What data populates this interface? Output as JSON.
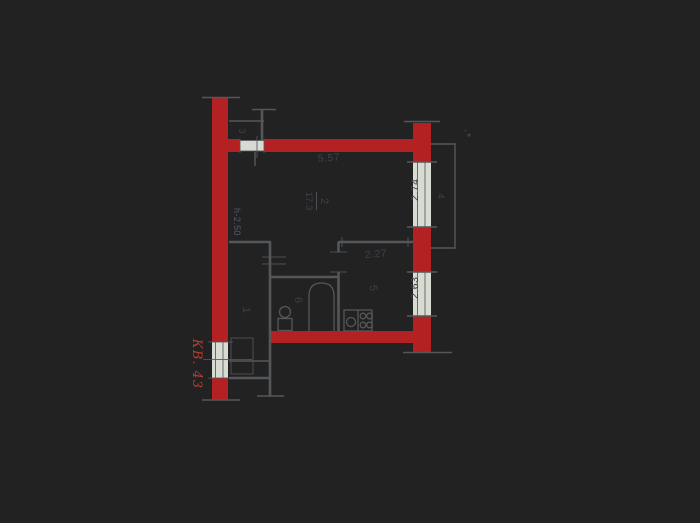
{
  "plan": {
    "apartment_label": "КВ. 43",
    "ceiling_height_label": "h-2.50",
    "rooms": {
      "hall": {
        "number": "1"
      },
      "living": {
        "number": "2",
        "area": "17.3"
      },
      "closet": {
        "number": "3"
      },
      "balcony": {
        "number": "4"
      },
      "kitchen": {
        "number": "5"
      },
      "bathroom": {
        "number": "6"
      }
    },
    "dimensions": {
      "living_width": "5.57",
      "living_window_width": "2.74",
      "kitchen_width": "2.27",
      "kitchen_window_width": "2.63"
    },
    "colors": {
      "wall_color": "#b92021",
      "line_color": "#54575a",
      "gap_color": "#d8dbd2",
      "dim_color": "#3c4045",
      "apt_color": "#c23a2e",
      "height_color": "#4c5a74"
    }
  }
}
